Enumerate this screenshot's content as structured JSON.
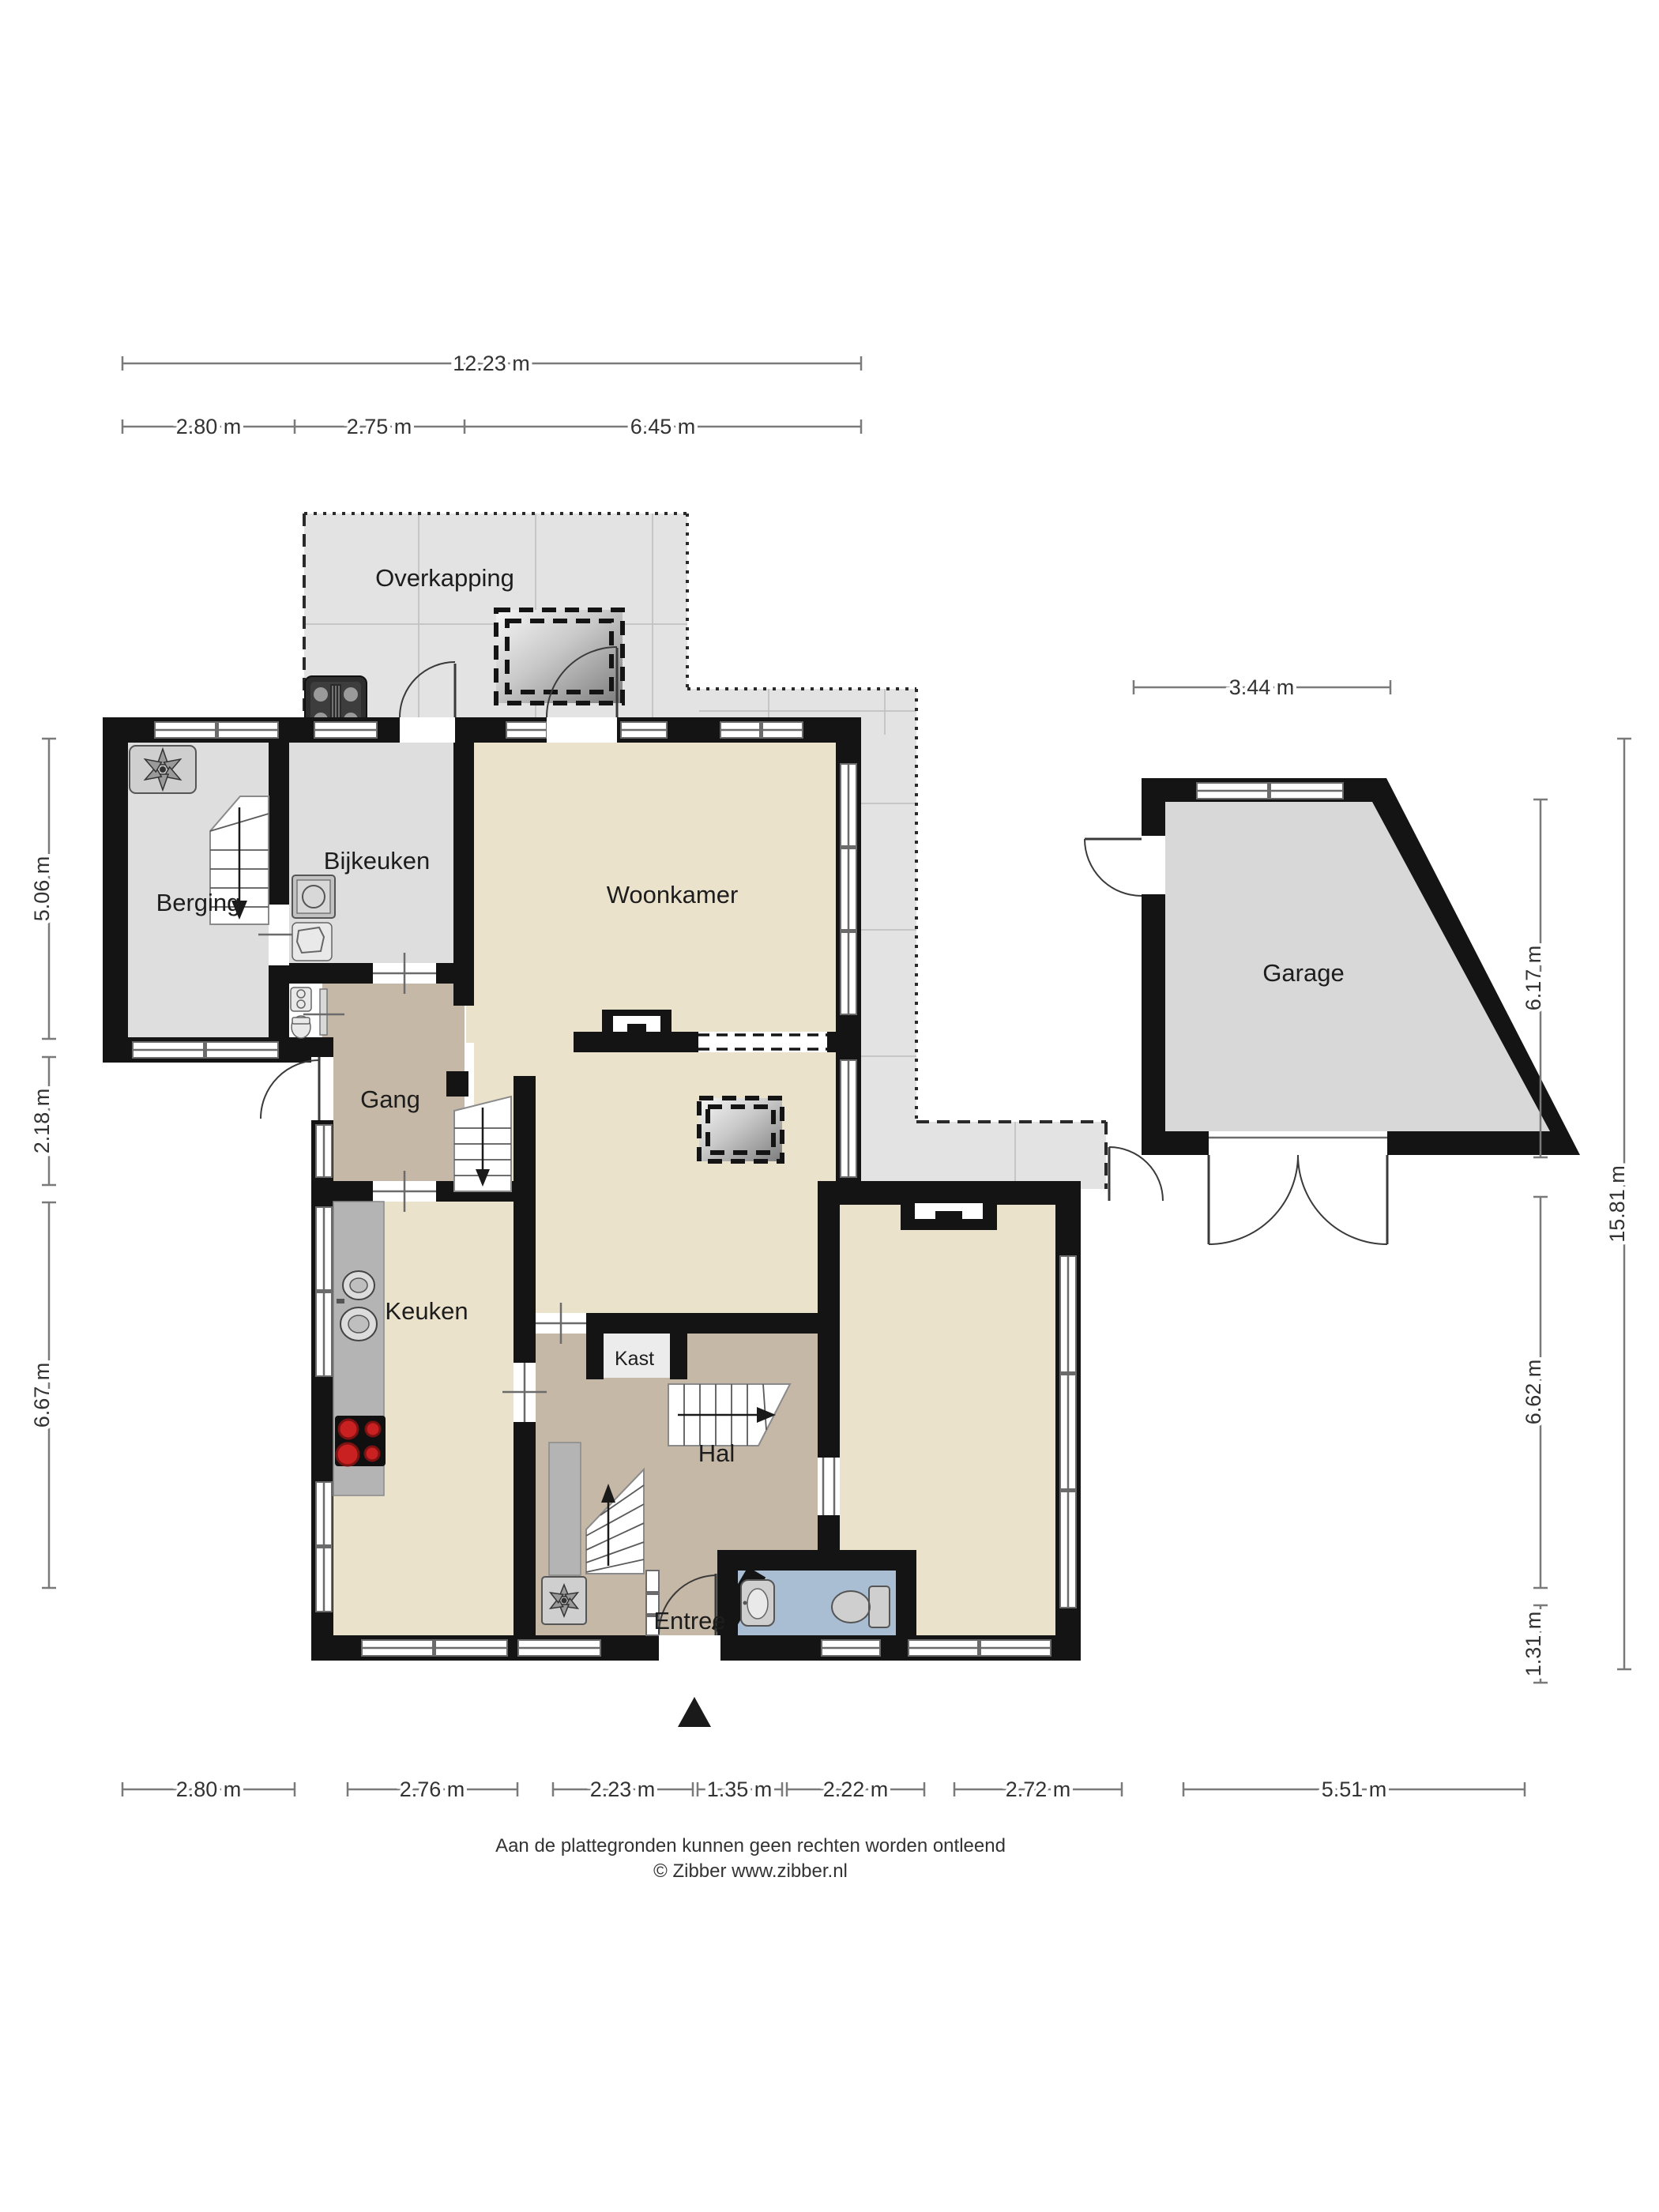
{
  "rooms": {
    "overkapping": "Overkapping",
    "berging": "Berging",
    "bijkeuken": "Bijkeuken",
    "woonkamer": "Woonkamer",
    "garage": "Garage",
    "gang": "Gang",
    "keuken": "Keuken",
    "kast": "Kast",
    "hal": "Hal",
    "entree": "Entree"
  },
  "dims": {
    "top_total": "12.23 m",
    "top_segments": [
      "2.80 m",
      "2.75 m",
      "6.45 m"
    ],
    "garage_width": "3.44 m",
    "left": [
      "5.06 m",
      "2.18 m",
      "6.67 m"
    ],
    "right_inner": [
      "6.17 m",
      "6.62 m",
      "1.31 m"
    ],
    "right_total": "15.81 m",
    "bottom": [
      "2.80 m",
      "2.76 m",
      "2.23 m",
      "1.35 m",
      "2.22 m",
      "2.72 m",
      "5.51 m"
    ]
  },
  "footer": {
    "line1": "Aan de plattegronden kunnen geen rechten worden ontleend",
    "line2": "© Zibber www.zibber.nl"
  },
  "colors": {
    "wall": "#141414",
    "floor_living": "#eae2cb",
    "floor_hall": "#c6b8a6",
    "floor_storage": "#dedede",
    "floor_toilet": "#a9bdd3",
    "terrace": "#e3e3e3",
    "hob_burner": "#c92121"
  },
  "icons": [
    "ventilation-fan-icon",
    "washer-icon",
    "boiler-icon",
    "kitchen-sink-icon",
    "hob-icon",
    "bbq-icon",
    "skylight-icon",
    "toilet-icon",
    "washbasin-icon",
    "entrance-marker-icon",
    "stairs-icon"
  ]
}
